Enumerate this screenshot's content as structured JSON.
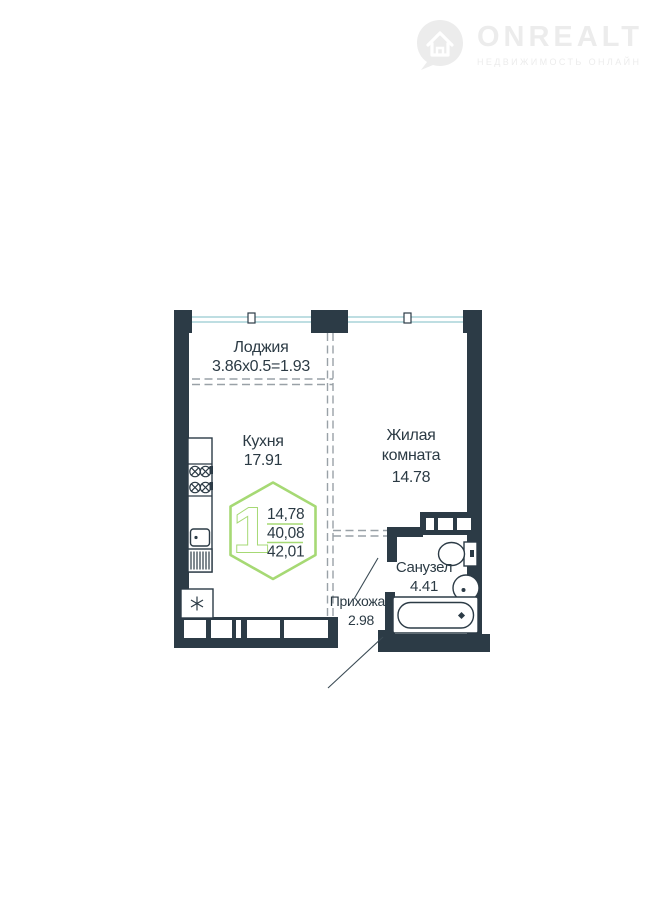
{
  "page": {
    "background": "#ffffff"
  },
  "logo": {
    "brand": "ONREALT",
    "tagline": "НЕДВИЖИМОСТЬ ОНЛАЙН",
    "icon": "house-pin-icon",
    "color": "#ececec"
  },
  "plan": {
    "type": "apartment-floor-plan",
    "rooms": {
      "loggia": {
        "name": "Лоджия",
        "dims": "3.86x0.5=1.93"
      },
      "kitchen": {
        "name": "Кухня",
        "area": "17.91"
      },
      "living": {
        "name_line1": "Жилая",
        "name_line2": "комната",
        "area": "14.78"
      },
      "bathroom": {
        "name": "Санузел",
        "area": "4.41"
      },
      "hallway": {
        "name": "Прихожая",
        "area": "2.98"
      }
    },
    "badge": {
      "rooms_count": "1",
      "living_area": "14,78",
      "area_without_loggia": "40,08",
      "total_area": "42,01"
    },
    "fixtures": [
      "stove",
      "kitchen-sink",
      "washing-machine",
      "fridge",
      "toilet",
      "washbasin",
      "bathtub",
      "ventilation-shaft"
    ],
    "colors": {
      "wall": "#2c3b46",
      "window": "#b5dade",
      "accent_green": "#a6d974",
      "dashed_line": "#99a1a7",
      "text": "#2b3a44"
    }
  }
}
